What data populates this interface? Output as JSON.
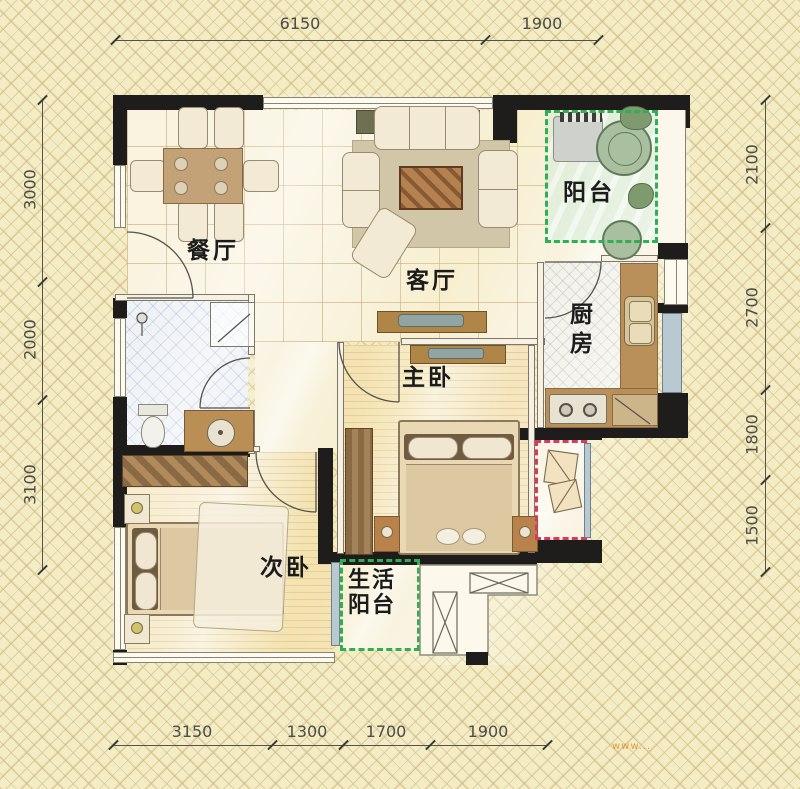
{
  "rooms": {
    "dining": {
      "label": "餐厅"
    },
    "living": {
      "label": "客厅"
    },
    "balcony": {
      "label": "阳台"
    },
    "kitchen": {
      "label": "厨房"
    },
    "master": {
      "label": "主卧"
    },
    "second": {
      "label": "次卧"
    },
    "utility": {
      "label": "生活阳台",
      "line1": "生活",
      "line2": "阳台"
    }
  },
  "dimensions": {
    "top": [
      "6150",
      "1900"
    ],
    "left": [
      "3000",
      "2000",
      "3100"
    ],
    "right": [
      "2100",
      "2700",
      "1800",
      "1500"
    ],
    "bottom": [
      "3150",
      "1300",
      "1700",
      "1900"
    ]
  },
  "watermark": "www...",
  "colors": {
    "wall": "#1e1d1b",
    "balcony_boundary": "#2fae54",
    "ac_platform_boundary": "#d63a5e",
    "counter": "#b9905a",
    "dimension_text": "#4c4c48",
    "label_text": "#1b1b1b",
    "watermark": "#e09a3a"
  }
}
